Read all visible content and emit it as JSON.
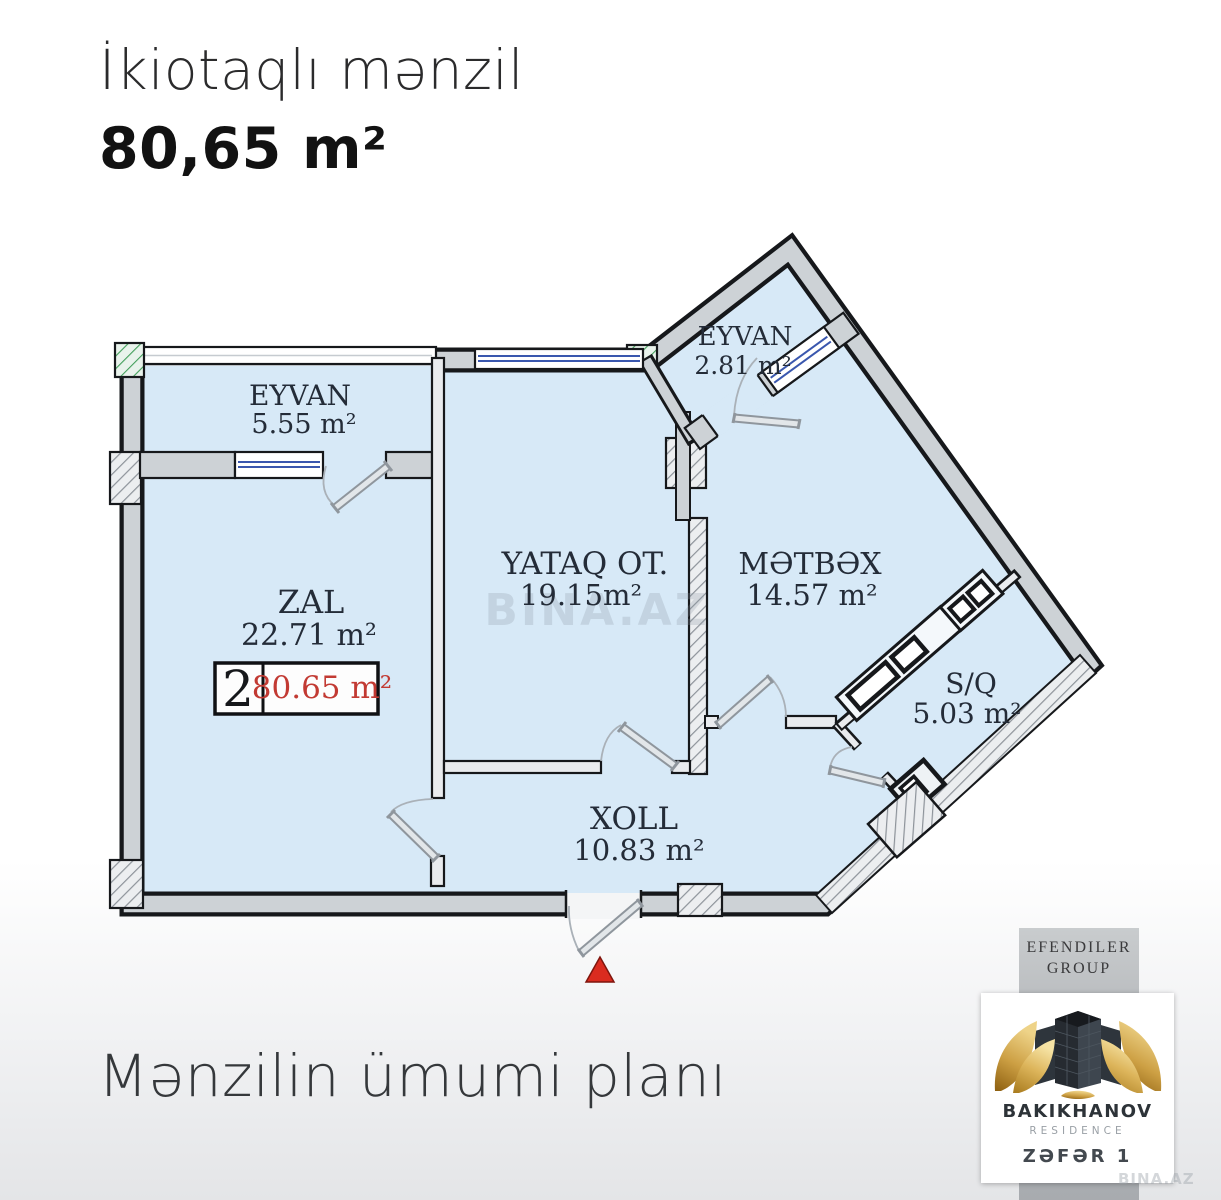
{
  "header": {
    "title": "İkiotaqlı mənzil",
    "area": "80,65 m²"
  },
  "footer": {
    "caption": "Mənzilin ümumi planı"
  },
  "watermark": {
    "text": "BINA.AZ"
  },
  "plan": {
    "badge": {
      "number": "2",
      "area": "80.65 m²"
    },
    "rooms": [
      {
        "name": "EYVAN",
        "area": "5.55 m²"
      },
      {
        "name": "EYVAN",
        "area": "2.81 m²"
      },
      {
        "name": "ZAL",
        "area": "22.71 m²"
      },
      {
        "name": "YATAQ OT.",
        "area": "19.15m²"
      },
      {
        "name": "MƏTBƏX",
        "area": "14.57 m²"
      },
      {
        "name": "S/Q",
        "area": "5.03 m²"
      },
      {
        "name": "XOLL",
        "area": "10.83 m²"
      }
    ]
  },
  "logo": {
    "company": "EFENDILER",
    "company2": "GROUP",
    "brand": "BAKIKHANOV",
    "brand_sub": "RESIDENCE",
    "project": "ZƏFƏR 1"
  },
  "colors": {
    "room_fill": "#d7e9f7",
    "wall_gray": "#cdd2d6",
    "window_blue": "#3a57ae",
    "badge_red": "#c23a33",
    "entrance_red": "#da2b1f",
    "gold": "#cda044"
  }
}
